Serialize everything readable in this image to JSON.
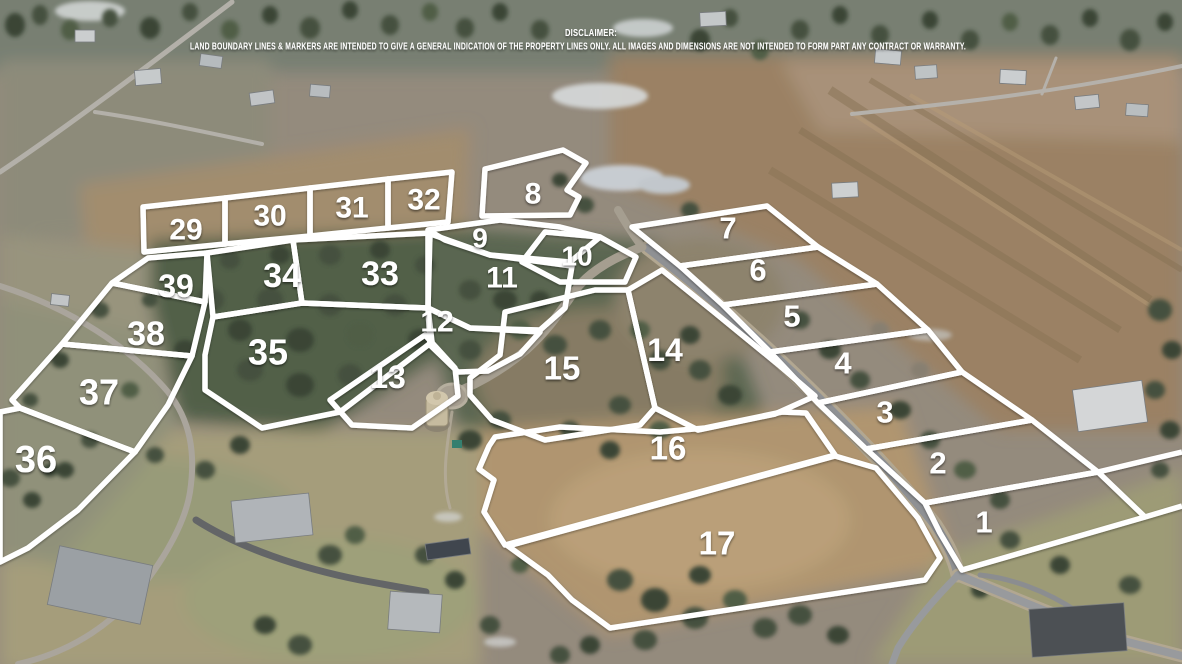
{
  "disclaimer": {
    "title": "DISCLAIMER:",
    "body": "LAND BOUNDARY LINES & MARKERS ARE INTENDED TO GIVE A GENERAL INDICATION OF THE PROPERTY LINES ONLY. ALL IMAGES AND DIMENSIONS ARE NOT INTENDED TO FORM PART ANY CONTRACT OR WARRANTY."
  },
  "map": {
    "boundary_color": "#ffffff",
    "label_color": "#ffffff",
    "line_width": 5.5,
    "default_label_size": 31,
    "extra_lines": [
      "1098,472 1182,452",
      "1145,517 1182,506"
    ],
    "lots": [
      {
        "number": "1",
        "size": 31,
        "label": {
          "x": 984,
          "y": 522
        },
        "points": "925,503 1098,472 1145,517 962,570 940,533"
      },
      {
        "number": "2",
        "size": 31,
        "label": {
          "x": 938,
          "y": 463
        },
        "points": "866,449 1032,420 1098,472 925,503"
      },
      {
        "number": "3",
        "size": 31,
        "label": {
          "x": 885,
          "y": 412
        },
        "points": "818,403 962,372 1032,420 866,449"
      },
      {
        "number": "4",
        "size": 31,
        "label": {
          "x": 843,
          "y": 363
        },
        "points": "770,352 928,330 962,372 818,403"
      },
      {
        "number": "5",
        "size": 31,
        "label": {
          "x": 792,
          "y": 316
        },
        "points": "723,305 877,284 928,330 770,352"
      },
      {
        "number": "6",
        "size": 31,
        "label": {
          "x": 758,
          "y": 270
        },
        "points": "680,266 818,247 877,284 723,305"
      },
      {
        "number": "7",
        "size": 31,
        "label": {
          "x": 728,
          "y": 228
        },
        "points": "632,227 767,206 818,247 680,266"
      },
      {
        "number": "8",
        "size": 30,
        "label": {
          "x": 533,
          "y": 194
        },
        "points": "485,169 563,150 586,163 567,190 579,197 570,215 482,216"
      },
      {
        "number": "9",
        "size": 28,
        "label": {
          "x": 480,
          "y": 238
        },
        "points": "428,230 500,220 560,227 600,237 570,262 490,255 445,240"
      },
      {
        "number": "10",
        "size": 28,
        "label": {
          "x": 577,
          "y": 256
        },
        "points": "545,232 600,237 636,257 625,282 560,282 522,262"
      },
      {
        "number": "11",
        "size": 30,
        "label": {
          "x": 502,
          "y": 278
        },
        "points": "428,233 490,255 572,266 565,308 540,330 470,328 428,308"
      },
      {
        "number": "12",
        "size": 30,
        "label": {
          "x": 437,
          "y": 322
        },
        "points": "428,308 470,328 540,332 520,354 488,371 458,372 430,345"
      },
      {
        "number": "13",
        "size": 32,
        "label": {
          "x": 388,
          "y": 377
        },
        "points": "330,400 425,335 455,368 458,396 412,428 352,425"
      },
      {
        "number": "14",
        "size": 32,
        "label": {
          "x": 665,
          "y": 350
        },
        "points": "628,290 662,270 714,312 780,366 815,396 775,414 698,430 655,408"
      },
      {
        "number": "15",
        "size": 33,
        "label": {
          "x": 562,
          "y": 368
        },
        "points": "505,312 595,290 628,290 655,408 640,425 545,440 492,420 470,395 470,378 500,355"
      },
      {
        "number": "16",
        "size": 33,
        "label": {
          "x": 668,
          "y": 448
        },
        "points": "495,437 560,427 660,432 705,428 782,412 806,413 835,455 505,545 484,512 494,480 479,469 489,446"
      },
      {
        "number": "17",
        "size": 33,
        "label": {
          "x": 717,
          "y": 543
        },
        "points": "508,546 835,456 876,468 918,518 940,558 925,580 610,628 572,600 548,575"
      },
      {
        "number": "29",
        "size": 30,
        "label": {
          "x": 186,
          "y": 230
        },
        "points": "143,207 225,198 225,244 144,252"
      },
      {
        "number": "30",
        "size": 30,
        "label": {
          "x": 270,
          "y": 216
        },
        "points": "225,198 310,188 310,236 225,244"
      },
      {
        "number": "31",
        "size": 30,
        "label": {
          "x": 352,
          "y": 208
        },
        "points": "310,188 388,179 388,228 310,236"
      },
      {
        "number": "32",
        "size": 30,
        "label": {
          "x": 424,
          "y": 200
        },
        "points": "388,179 452,172 448,222 388,228"
      },
      {
        "number": "33",
        "size": 34,
        "label": {
          "x": 380,
          "y": 274
        },
        "points": "293,240 430,233 428,308 302,303"
      },
      {
        "number": "34",
        "size": 34,
        "label": {
          "x": 282,
          "y": 276
        },
        "points": "207,253 293,240 302,303 213,317"
      },
      {
        "number": "35",
        "size": 36,
        "label": {
          "x": 268,
          "y": 352
        },
        "points": "213,317 302,303 428,308 432,342 340,412 262,428 205,390 205,355"
      },
      {
        "number": "36",
        "size": 38,
        "label": {
          "x": 36,
          "y": 460
        },
        "points": "0,412 20,408 135,452 78,510 28,548 0,562"
      },
      {
        "number": "37",
        "size": 36,
        "label": {
          "x": 99,
          "y": 392
        },
        "points": "62,344 192,356 168,405 135,452 20,408 12,400"
      },
      {
        "number": "38",
        "size": 34,
        "label": {
          "x": 146,
          "y": 334
        },
        "points": "112,283 205,302 192,356 62,344"
      },
      {
        "number": "39",
        "size": 32,
        "label": {
          "x": 176,
          "y": 286
        },
        "points": "148,258 207,253 205,302 112,283"
      }
    ]
  }
}
